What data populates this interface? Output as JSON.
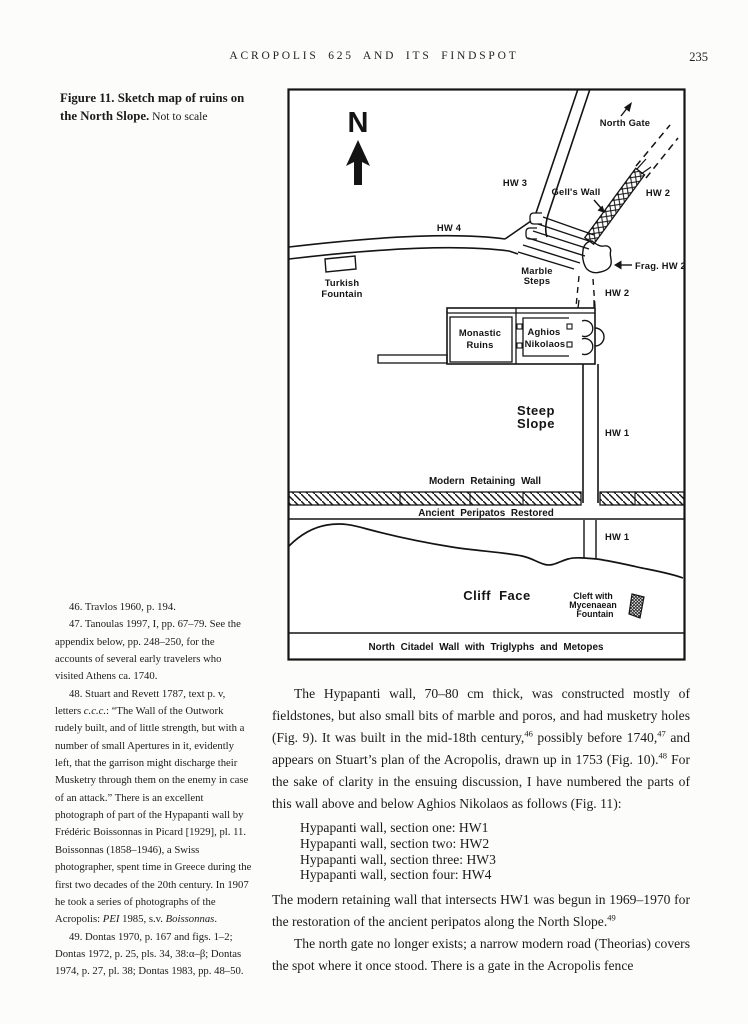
{
  "header": {
    "title": "ACROPOLIS 625 AND ITS FINDSPOT",
    "page_number": "235"
  },
  "caption": {
    "title": "Figure 11. Sketch map of ruins on the North Slope.",
    "note": " Not to scale"
  },
  "map": {
    "labels": {
      "compass": "N",
      "north_gate": "North Gate",
      "hw3": "HW 3",
      "hw4": "HW 4",
      "gells_wall": "Gell's Wall",
      "hw2_upper": "HW 2",
      "frag_hw2": "Frag. HW 2",
      "hw2_mid": "HW 2",
      "marble_line1": "Marble",
      "marble_line2": "Steps",
      "turkish_line1": "Turkish",
      "turkish_line2": "Fountain",
      "monastic_line1": "Monastic",
      "monastic_line2": "Ruins",
      "aghios_line1": "Aghios",
      "aghios_line2": "Nikolaos",
      "steep_line1": "Steep",
      "steep_line2": "Slope",
      "hw1_upper": "HW 1",
      "modern_retaining_wall": "Modern Retaining Wall",
      "ancient_peripatos": "Ancient Peripatos Restored",
      "hw1_lower": "HW 1",
      "cliff_face": "Cliff Face",
      "cleft_line1": "Cleft with",
      "cleft_line2": "Mycenaean",
      "cleft_line3": "Fountain",
      "citadel_wall": "North Citadel Wall with Triglyphs and Metopes"
    }
  },
  "body": {
    "para1": [
      {
        "t": "The Hypapanti wall, 70–80 cm thick, was constructed mostly of fieldstones, but also small bits of marble and poros, and had musketry holes (Fig. 9). It was built in the mid-18th century,"
      },
      {
        "t": "46",
        "sup": true
      },
      {
        "t": " possibly before 1740,"
      },
      {
        "t": "47",
        "sup": true
      },
      {
        "t": " and appears on Stuart’s plan of the Acropolis, drawn up in 1753 (Fig. 10)."
      },
      {
        "t": "48",
        "sup": true
      },
      {
        "t": " For the sake of clarity in the ensuing discussion, I have numbered the parts of this wall above and below Aghios Nikolaos as follows (Fig. 11):"
      }
    ],
    "list": [
      "Hypapanti wall, section one: HW1",
      "Hypapanti wall, section two: HW2",
      "Hypapanti wall, section three: HW3",
      "Hypapanti wall, section four: HW4"
    ],
    "para2": [
      {
        "t": "The modern retaining wall that intersects HW1 was begun in 1969–1970 for the restoration of the ancient peripatos along the North Slope."
      },
      {
        "t": "49",
        "sup": true
      }
    ],
    "para3": [
      {
        "t": "The north gate no longer exists; a narrow modern road (Theorias) covers the spot where it once stood. There is a gate in the Acropolis fence"
      }
    ]
  },
  "footnotes": [
    [
      {
        "t": "46. Travlos 1960, p. 194."
      }
    ],
    [
      {
        "t": "47. Tanoulas 1997, I, pp. 67–79. See the appendix below, pp. 248–250, for the accounts of several early travelers who visited Athens ca. 1740."
      }
    ],
    [
      {
        "t": "48. Stuart and Revett 1787, text p. v, letters "
      },
      {
        "t": "c.c.c.",
        "i": true
      },
      {
        "t": ": “The Wall of the Outwork rudely built, and of little strength, but with a number of small Apertures in it, evidently left, that the garrison might discharge their Musketry through them on the enemy in case of an attack.” There is an excellent photograph of part of the Hypapanti wall by Frédéric Boissonnas in Picard [1929], pl. 11. Boissonnas (1858–1946), a Swiss photographer, spent time in Greece during the first two decades of the 20th century. In 1907 he took a series of photographs of the Acropolis: "
      },
      {
        "t": "PEI",
        "i": true
      },
      {
        "t": " 1985, s.v. "
      },
      {
        "t": "Boissonnas",
        "i": true
      },
      {
        "t": "."
      }
    ],
    [
      {
        "t": "49. Dontas 1970, p. 167 and figs. 1–2; Dontas 1972, p. 25, pls. 34, 38:α–β; Dontas 1974, p. 27, pl. 38; Dontas 1983, pp. 48–50."
      }
    ]
  ]
}
